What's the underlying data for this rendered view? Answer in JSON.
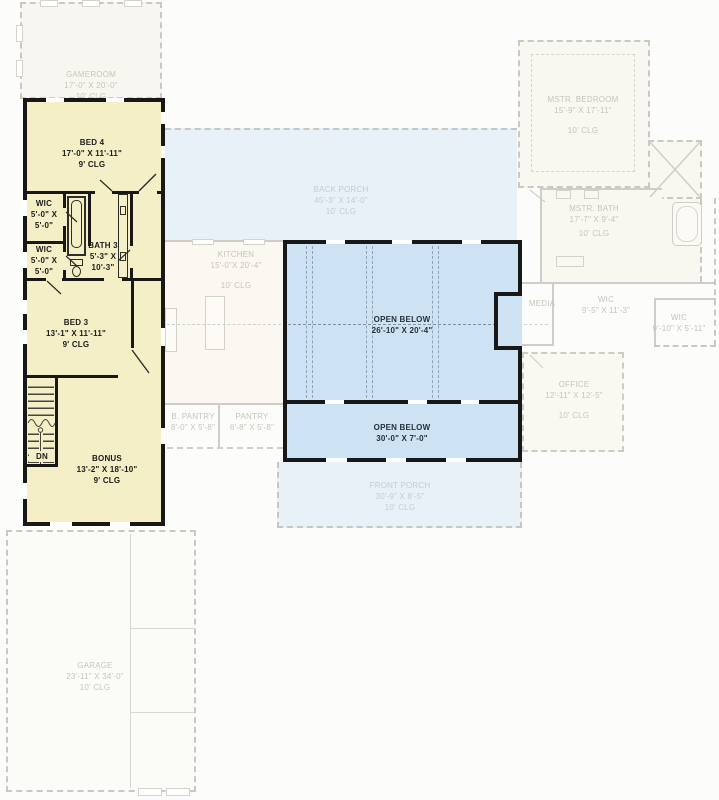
{
  "plan_type": "second-floor-plan",
  "colors": {
    "highlight_fill": "#f4efc6",
    "open_below_fill": "#cde2f3",
    "porch_fill": "#e8f1f8",
    "wall_black": "#181818",
    "faded_wall": "#cfcdc6",
    "faded_text": "#c8c5ba",
    "porch_text": "#c2ccd5"
  },
  "rooms": {
    "gameroom": {
      "lines": [
        "GAMEROOM",
        "17'-0\" X 20'-0\"",
        "10' CLG"
      ]
    },
    "bed4": {
      "lines": [
        "BED 4",
        "17'-0\" X 11'-11\"",
        "9' CLG"
      ]
    },
    "wic1": {
      "lines": [
        "WIC",
        "5'-0\" X",
        "5'-0\""
      ]
    },
    "wic2": {
      "lines": [
        "WIC",
        "5'-0\" X",
        "5'-0\""
      ]
    },
    "bath3": {
      "lines": [
        "BATH 3",
        "5'-3\" X",
        "10'-3\""
      ]
    },
    "bed3": {
      "lines": [
        "BED 3",
        "13'-1\" X 11'-11\"",
        "9' CLG"
      ]
    },
    "stairs": {
      "label": "DN"
    },
    "bonus": {
      "lines": [
        "BONUS",
        "13'-2\" X 18'-10\"",
        "9' CLG"
      ]
    },
    "back_porch": {
      "lines": [
        "BACK PORCH",
        "45'-3\" X 14'-0\"",
        "10' CLG"
      ]
    },
    "kitchen": {
      "lines": [
        "KITCHEN",
        "15'-0\"X 20'-4\"",
        "10' CLG"
      ]
    },
    "b_pantry": {
      "lines": [
        "B. PANTRY",
        "8'-0\" X 5'-8\""
      ]
    },
    "pantry": {
      "lines": [
        "PANTRY",
        "6'-8\" X 5'-8\""
      ]
    },
    "open_below_main": {
      "lines": [
        "OPEN BELOW",
        "26'-10\" X 20'-4\""
      ]
    },
    "open_below_front": {
      "lines": [
        "OPEN BELOW",
        "30'-0\" X 7'-0\""
      ]
    },
    "front_porch": {
      "lines": [
        "FRONT PORCH",
        "30'-9\" X 8'-5\"",
        "10' CLG"
      ]
    },
    "mstr_bedroom": {
      "lines": [
        "MSTR. BEDROOM",
        "15'-9\" X 17'-11\"",
        "10' CLG"
      ]
    },
    "mstr_bath": {
      "lines": [
        "MSTR. BATH",
        "17'-7\" X 9'-4\"",
        "10' CLG"
      ]
    },
    "media": {
      "lines": [
        "MEDIA"
      ]
    },
    "wic_master": {
      "lines": [
        "WIC",
        "9'-5\" X 11'-3\""
      ]
    },
    "wic_master2": {
      "lines": [
        "WIC",
        "9'-10\" X 5'-11\""
      ]
    },
    "office": {
      "lines": [
        "OFFICE",
        "12'-11\" X 12'-5\"",
        "10' CLG"
      ]
    },
    "garage": {
      "lines": [
        "GARAGE",
        "23'-11\" X 34'-0\"",
        "10' CLG"
      ]
    }
  }
}
